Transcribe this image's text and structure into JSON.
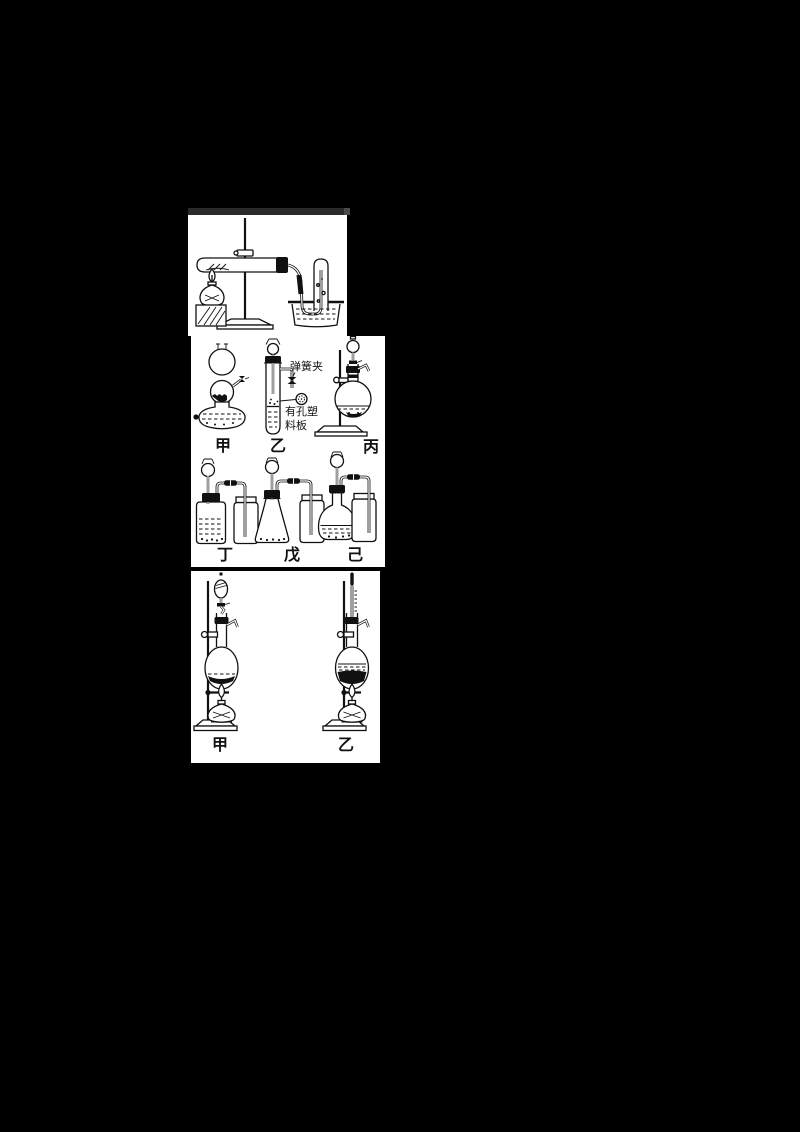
{
  "canvas": {
    "background": "#000000",
    "panel_background": "#ffffff",
    "ink_color": "#111111",
    "figure1_header_bar_color": "#2b2b2b"
  },
  "figure1": {
    "name": "heated-test-tube-gas-collection-over-water",
    "apparatus_icons": [
      "iron-stand",
      "large-test-tube-with-stopper",
      "alcohol-lamp",
      "wood-block",
      "delivery-tube",
      "water-trough",
      "collecting-test-tube"
    ]
  },
  "figure2": {
    "row1": {
      "items": [
        {
          "label": "甲",
          "apparatus_icon": "kipp-generator"
        },
        {
          "label": "乙",
          "apparatus_icon": "test-tube-with-thistle-funnel",
          "annotations": {
            "spring_clamp": "弹簧夹",
            "perforated_plate": [
              "有孔塑",
              "料板"
            ]
          }
        },
        {
          "label": "丙",
          "apparatus_icon": "flask-on-stand-with-dropping-funnel"
        }
      ]
    },
    "row2": {
      "items": [
        {
          "label": "丁",
          "apparatus_icon": "wide-mouth-bottle-generator-with-gas-bottle"
        },
        {
          "label": "戊",
          "apparatus_icon": "conical-flask-generator-with-gas-bottle"
        },
        {
          "label": "己",
          "apparatus_icon": "flat-bottom-flask-generator-with-gas-bottle"
        }
      ]
    }
  },
  "figure3": {
    "items": [
      {
        "label": "甲",
        "apparatus_icon": "distillation-flask-with-separating-funnel-on-stand"
      },
      {
        "label": "乙",
        "apparatus_icon": "distillation-flask-with-thermometer-on-stand"
      }
    ]
  }
}
